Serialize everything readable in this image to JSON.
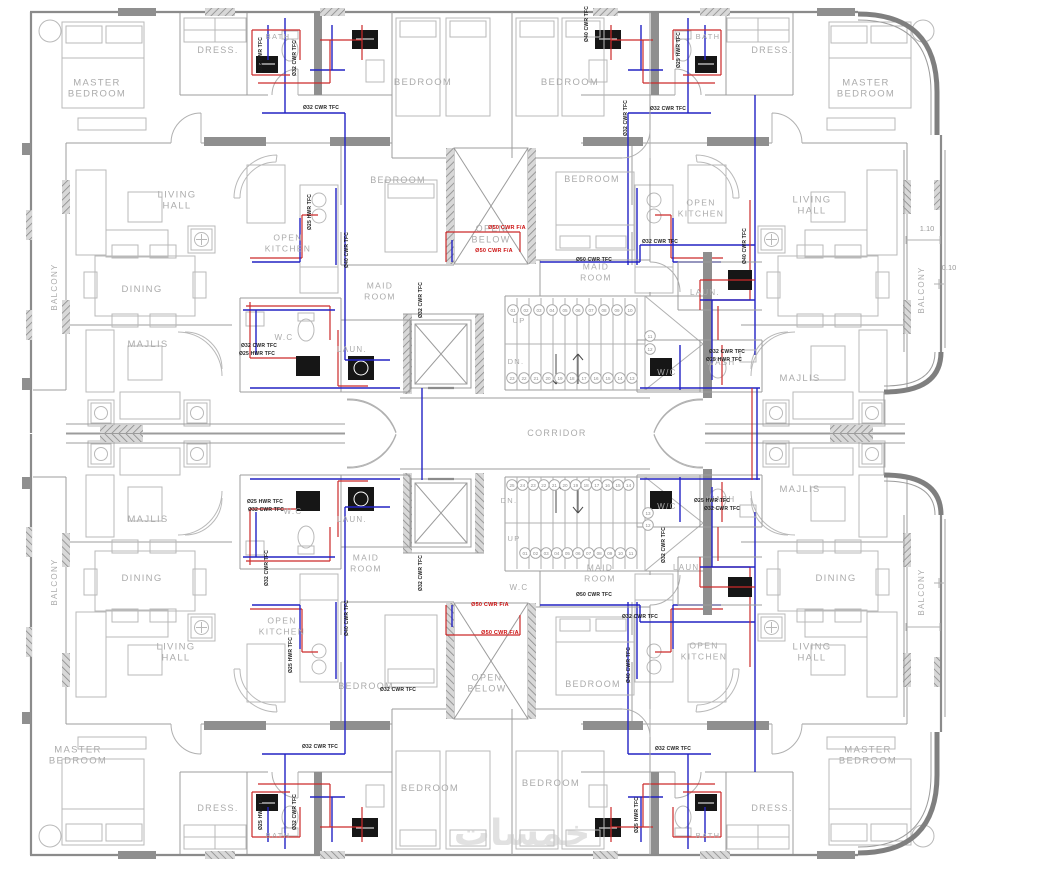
{
  "drawing": {
    "kind": "apartment-typical-floor-plan-with-water-supply-piping",
    "colors": {
      "cold_water": "#2323c4",
      "hot_water": "#cc2a2a",
      "alarm": "#cc1111",
      "wall": "#9c9c9c",
      "label": "#ababab"
    },
    "watermark": {
      "text": "خمسات",
      "x": 522,
      "y": 845,
      "size": 36
    }
  },
  "room_labels": [
    {
      "id": "master-bedroom-tl",
      "lines": [
        "MASTER",
        "BEDROOM"
      ],
      "x": 97,
      "y": 88,
      "size": 9.5
    },
    {
      "id": "dress-tl",
      "lines": [
        "DRESS."
      ],
      "x": 218,
      "y": 50,
      "size": 9
    },
    {
      "id": "bath-tl",
      "lines": [
        "BATH"
      ],
      "x": 278,
      "y": 36,
      "size": 7.5
    },
    {
      "id": "bedroom-t1",
      "lines": [
        "BEDROOM"
      ],
      "x": 423,
      "y": 82,
      "size": 9.5
    },
    {
      "id": "bedroom-t2",
      "lines": [
        "BEDROOM"
      ],
      "x": 570,
      "y": 82,
      "size": 9.5
    },
    {
      "id": "bath-tr",
      "lines": [
        "BATH"
      ],
      "x": 708,
      "y": 36,
      "size": 7.5
    },
    {
      "id": "dress-tr",
      "lines": [
        "DRESS."
      ],
      "x": 772,
      "y": 50,
      "size": 9
    },
    {
      "id": "master-bedroom-tr",
      "lines": [
        "MASTER",
        "BEDROOM"
      ],
      "x": 866,
      "y": 88,
      "size": 9.5
    },
    {
      "id": "living-hall-tl",
      "lines": [
        "LIVING",
        "HALL"
      ],
      "x": 177,
      "y": 200,
      "size": 9.5
    },
    {
      "id": "bedroom-ml",
      "lines": [
        "BEDROOM"
      ],
      "x": 398,
      "y": 180,
      "size": 9
    },
    {
      "id": "bedroom-mr",
      "lines": [
        "BEDROOM"
      ],
      "x": 592,
      "y": 179,
      "size": 9
    },
    {
      "id": "open-kitchen-tl",
      "lines": [
        "OPEN",
        "KITCHEN"
      ],
      "x": 288,
      "y": 243,
      "size": 8.5
    },
    {
      "id": "open-below-t",
      "lines": [
        "OPEN",
        "BELOW"
      ],
      "x": 491,
      "y": 234,
      "size": 9
    },
    {
      "id": "open-kitchen-tr",
      "lines": [
        "OPEN",
        "KITCHEN"
      ],
      "x": 701,
      "y": 208,
      "size": 8.5
    },
    {
      "id": "living-hall-tr",
      "lines": [
        "LIVING",
        "HALL"
      ],
      "x": 812,
      "y": 205,
      "size": 9.5
    },
    {
      "id": "balcony-left-up",
      "lines": [
        "BALCONY"
      ],
      "x": 57,
      "y": 287,
      "size": 8,
      "rot": -90
    },
    {
      "id": "balcony-right-up",
      "lines": [
        "BALCONY"
      ],
      "x": 924,
      "y": 290,
      "size": 8,
      "rot": -90
    },
    {
      "id": "dining-tl",
      "lines": [
        "DINING"
      ],
      "x": 142,
      "y": 289,
      "size": 9.5
    },
    {
      "id": "maid-room-tl",
      "lines": [
        "MAID",
        "ROOM"
      ],
      "x": 380,
      "y": 291,
      "size": 8.5
    },
    {
      "id": "maid-room-tr",
      "lines": [
        "MAID",
        "ROOM"
      ],
      "x": 596,
      "y": 272,
      "size": 8.5
    },
    {
      "id": "majlis-tl",
      "lines": [
        "MAJLIS"
      ],
      "x": 148,
      "y": 344,
      "size": 9.5
    },
    {
      "id": "laun-tl",
      "lines": [
        "LAUN."
      ],
      "x": 352,
      "y": 349,
      "size": 8
    },
    {
      "id": "laun-tr",
      "lines": [
        "LAUN."
      ],
      "x": 705,
      "y": 292,
      "size": 8
    },
    {
      "id": "wc-tl",
      "lines": [
        "W.C"
      ],
      "x": 284,
      "y": 337,
      "size": 8
    },
    {
      "id": "wash-tr",
      "lines": [
        "WASH"
      ],
      "x": 721,
      "y": 362,
      "size": 8
    },
    {
      "id": "wc-tr",
      "lines": [
        "W/C"
      ],
      "x": 667,
      "y": 372,
      "size": 8
    },
    {
      "id": "majlis-tr",
      "lines": [
        "MAJLIS"
      ],
      "x": 800,
      "y": 378,
      "size": 9.5
    },
    {
      "id": "corridor",
      "lines": [
        "CORRIDOR"
      ],
      "x": 557,
      "y": 433,
      "size": 9
    },
    {
      "id": "majlis-bl",
      "lines": [
        "MAJLIS"
      ],
      "x": 148,
      "y": 519,
      "size": 9.5
    },
    {
      "id": "wc-bl",
      "lines": [
        "W.C"
      ],
      "x": 293,
      "y": 511,
      "size": 8
    },
    {
      "id": "laun-bl",
      "lines": [
        "LAUN."
      ],
      "x": 352,
      "y": 519,
      "size": 8
    },
    {
      "id": "maid-room-bl",
      "lines": [
        "MAID",
        "ROOM"
      ],
      "x": 366,
      "y": 563,
      "size": 8.5
    },
    {
      "id": "wash-br",
      "lines": [
        "WASH"
      ],
      "x": 721,
      "y": 499,
      "size": 8
    },
    {
      "id": "wc-br",
      "lines": [
        "W/C"
      ],
      "x": 667,
      "y": 506,
      "size": 8
    },
    {
      "id": "majlis-br",
      "lines": [
        "MAJLIS"
      ],
      "x": 800,
      "y": 489,
      "size": 9.5
    },
    {
      "id": "laun-br",
      "lines": [
        "LAUN."
      ],
      "x": 688,
      "y": 567,
      "size": 8
    },
    {
      "id": "wc-c",
      "lines": [
        "W.C"
      ],
      "x": 519,
      "y": 587,
      "size": 8
    },
    {
      "id": "maid-room-br",
      "lines": [
        "MAID",
        "ROOM"
      ],
      "x": 600,
      "y": 573,
      "size": 8.5
    },
    {
      "id": "dining-bl",
      "lines": [
        "DINING"
      ],
      "x": 142,
      "y": 578,
      "size": 9.5
    },
    {
      "id": "dining-br",
      "lines": [
        "DINING"
      ],
      "x": 836,
      "y": 578,
      "size": 9.5
    },
    {
      "id": "balcony-left-low",
      "lines": [
        "BALCONY"
      ],
      "x": 57,
      "y": 582,
      "size": 8,
      "rot": -90
    },
    {
      "id": "balcony-right-low",
      "lines": [
        "BALCONY"
      ],
      "x": 924,
      "y": 592,
      "size": 8,
      "rot": -90
    },
    {
      "id": "open-kitchen-bl",
      "lines": [
        "OPEN",
        "KITCHEN"
      ],
      "x": 282,
      "y": 626,
      "size": 8.5
    },
    {
      "id": "open-kitchen-br",
      "lines": [
        "OPEN",
        "KITCHEN"
      ],
      "x": 704,
      "y": 651,
      "size": 8.5
    },
    {
      "id": "living-hall-bl",
      "lines": [
        "LIVING",
        "HALL"
      ],
      "x": 176,
      "y": 652,
      "size": 9.5
    },
    {
      "id": "living-hall-br",
      "lines": [
        "LIVING",
        "HALL"
      ],
      "x": 812,
      "y": 652,
      "size": 9.5
    },
    {
      "id": "bedroom-bl",
      "lines": [
        "BEDROOM"
      ],
      "x": 366,
      "y": 686,
      "size": 9
    },
    {
      "id": "open-below-b",
      "lines": [
        "OPEN",
        "BELOW"
      ],
      "x": 487,
      "y": 683,
      "size": 9
    },
    {
      "id": "bedroom-bm",
      "lines": [
        "BEDROOM"
      ],
      "x": 593,
      "y": 684,
      "size": 9
    },
    {
      "id": "bedroom-b1",
      "lines": [
        "BEDROOM"
      ],
      "x": 430,
      "y": 788,
      "size": 9.5
    },
    {
      "id": "bedroom-b2",
      "lines": [
        "BEDROOM"
      ],
      "x": 551,
      "y": 783,
      "size": 9.5
    },
    {
      "id": "master-bedroom-bl",
      "lines": [
        "MASTER",
        "BEDROOM"
      ],
      "x": 78,
      "y": 755,
      "size": 9.5
    },
    {
      "id": "dress-bl",
      "lines": [
        "DRESS."
      ],
      "x": 218,
      "y": 808,
      "size": 9
    },
    {
      "id": "bath-bl",
      "lines": [
        "BATH"
      ],
      "x": 278,
      "y": 835,
      "size": 7.5
    },
    {
      "id": "bath-br",
      "lines": [
        "BATH"
      ],
      "x": 708,
      "y": 835,
      "size": 7.5
    },
    {
      "id": "dress-br",
      "lines": [
        "DRESS."
      ],
      "x": 772,
      "y": 808,
      "size": 9
    },
    {
      "id": "master-bedroom-br",
      "lines": [
        "MASTER",
        "BEDROOM"
      ],
      "x": 868,
      "y": 755,
      "size": 9.5
    }
  ],
  "pipe_labels": [
    {
      "t": "Ø32 CWR TFC",
      "x": 321,
      "y": 109,
      "r": 0
    },
    {
      "t": "Ø32 CWR TFC",
      "x": 668,
      "y": 110,
      "r": 0
    },
    {
      "t": "Ø25 HWR TFC",
      "x": 262,
      "y": 55,
      "r": -90
    },
    {
      "t": "Ø25 HWR TFC",
      "x": 680,
      "y": 50,
      "r": -90
    },
    {
      "t": "Ø32 CWR TFC",
      "x": 296,
      "y": 58,
      "r": -90
    },
    {
      "t": "Ø32 CWR TFC",
      "x": 627,
      "y": 118,
      "r": -90
    },
    {
      "t": "Ø40 CWR TFC",
      "x": 588,
      "y": 24,
      "r": -90
    },
    {
      "t": "Ø25 HWR TFC",
      "x": 311,
      "y": 212,
      "r": -90
    },
    {
      "t": "Ø40 CWR TFC",
      "x": 348,
      "y": 250,
      "r": -90
    },
    {
      "t": "Ø40 CWR TFC",
      "x": 746,
      "y": 246,
      "r": -90
    },
    {
      "t": "Ø32 CWR TFC",
      "x": 660,
      "y": 243,
      "r": 0
    },
    {
      "t": "Ø50 CWR TFC",
      "x": 594,
      "y": 261,
      "r": 0
    },
    {
      "t": "Ø32 CWR TFC",
      "x": 422,
      "y": 300,
      "r": -90
    },
    {
      "t": "Ø32 CWR TFC",
      "x": 259,
      "y": 347,
      "r": 0
    },
    {
      "t": "Ø25 HWR TFC",
      "x": 257,
      "y": 355,
      "r": 0
    },
    {
      "t": "Ø32 CWR TFC",
      "x": 727,
      "y": 353,
      "r": 0
    },
    {
      "t": "Ø25 HWR TFC",
      "x": 724,
      "y": 361,
      "r": 0
    },
    {
      "t": "Ø25 HWR TFC",
      "x": 265,
      "y": 503,
      "r": 0
    },
    {
      "t": "Ø32 CWR TFC",
      "x": 266,
      "y": 511,
      "r": 0
    },
    {
      "t": "Ø25 HWR TFC",
      "x": 712,
      "y": 502,
      "r": 0
    },
    {
      "t": "Ø32 CWR TFC",
      "x": 722,
      "y": 510,
      "r": 0
    },
    {
      "t": "Ø32 CWR TFC",
      "x": 665,
      "y": 545,
      "r": -90
    },
    {
      "t": "Ø32 CWR TFC",
      "x": 268,
      "y": 568,
      "r": -90
    },
    {
      "t": "Ø32 CWR TFC",
      "x": 422,
      "y": 573,
      "r": -90
    },
    {
      "t": "Ø50 CWR TFC",
      "x": 594,
      "y": 596,
      "r": 0
    },
    {
      "t": "Ø32 CWR TFC",
      "x": 640,
      "y": 618,
      "r": 0
    },
    {
      "t": "Ø40 CWR TFC",
      "x": 348,
      "y": 618,
      "r": -90
    },
    {
      "t": "Ø40 CWR TFC",
      "x": 630,
      "y": 665,
      "r": -90
    },
    {
      "t": "Ø25 HWR TFC",
      "x": 292,
      "y": 655,
      "r": -90
    },
    {
      "t": "Ø32 CWR TFC",
      "x": 398,
      "y": 691,
      "r": 0
    },
    {
      "t": "Ø32 CWR TFC",
      "x": 320,
      "y": 748,
      "r": 0
    },
    {
      "t": "Ø32 CWR TFC",
      "x": 673,
      "y": 750,
      "r": 0
    },
    {
      "t": "Ø25 HWR TFC",
      "x": 262,
      "y": 812,
      "r": -90
    },
    {
      "t": "Ø25 HWR TFC",
      "x": 638,
      "y": 815,
      "r": -90
    },
    {
      "t": "Ø32 CWR TFC",
      "x": 296,
      "y": 812,
      "r": -90
    }
  ],
  "alarm_labels": [
    {
      "t": "Ø50 CWR F/A",
      "x": 507,
      "y": 229
    },
    {
      "t": "Ø50 CWR F/A",
      "x": 494,
      "y": 252
    },
    {
      "t": "Ø50 CWR F/A",
      "x": 490,
      "y": 606
    },
    {
      "t": "Ø50 CWR F/A",
      "x": 500,
      "y": 634
    }
  ],
  "dimensions": [
    {
      "t": "1.10",
      "x": 927,
      "y": 231
    },
    {
      "t": "0.10",
      "x": 949,
      "y": 270
    }
  ],
  "stairs": {
    "up_label": "UP",
    "dn_label": "DN.",
    "flights": [
      {
        "up": {
          "x": 519,
          "y": 323
        },
        "dn": {
          "x": 516,
          "y": 364
        },
        "rows": [
          {
            "nums": [
              "01",
              "02",
              "03",
              "04",
              "05",
              "06",
              "07",
              "08",
              "09",
              "10"
            ],
            "x": 513,
            "y": 310,
            "dx": 13,
            "dy": 0
          },
          {
            "nums": [
              "23",
              "22",
              "21",
              "20",
              "19",
              "18",
              "17",
              "16",
              "15",
              "14",
              "13"
            ],
            "x": 512,
            "y": 378,
            "dx": 12,
            "dy": 0
          },
          {
            "nums": [
              "11",
              "12"
            ],
            "x": 650,
            "y": 336,
            "dx": 0,
            "dy": 13
          }
        ]
      },
      {
        "dn": {
          "x": 509,
          "y": 503
        },
        "up": {
          "x": 514,
          "y": 541
        },
        "rows": [
          {
            "nums": [
              "25",
              "24",
              "23",
              "22",
              "21",
              "20",
              "19",
              "18",
              "17",
              "16",
              "15",
              "14"
            ],
            "x": 512,
            "y": 485,
            "dx": 10.6,
            "dy": 0
          },
          {
            "nums": [
              "01",
              "02",
              "03",
              "04",
              "05",
              "06",
              "07",
              "08",
              "09",
              "10",
              "11"
            ],
            "x": 525,
            "y": 553,
            "dx": 10.6,
            "dy": 0
          },
          {
            "nums": [
              "13",
              "12"
            ],
            "x": 648,
            "y": 513,
            "dx": 0,
            "dy": 12
          }
        ]
      }
    ]
  }
}
